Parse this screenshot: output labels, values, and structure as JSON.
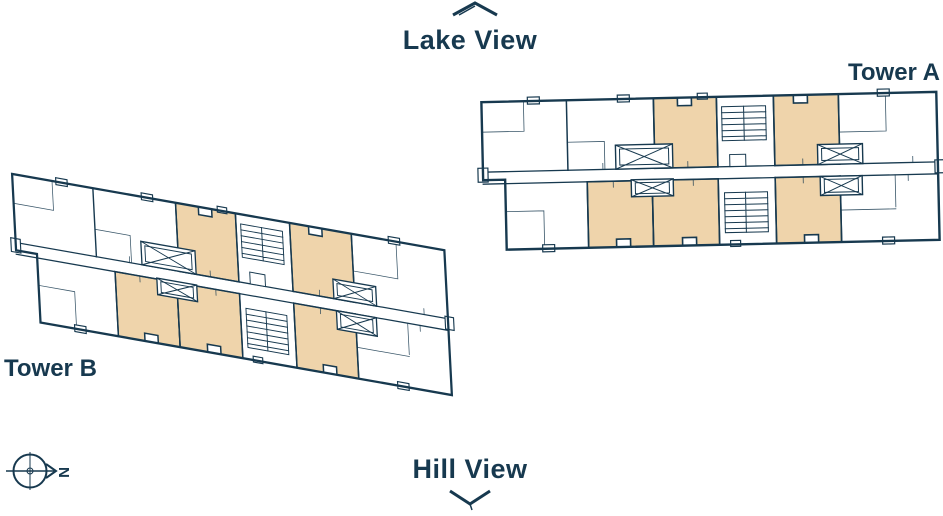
{
  "canvas": {
    "width": 943,
    "height": 516,
    "background": "#ffffff"
  },
  "colors": {
    "line_navy": "#17394f",
    "highlighted_unit_beige": "#efd4ab",
    "plan_background": "#ffffff"
  },
  "header": {
    "lake_view_label": "Lake View"
  },
  "footer": {
    "hill_view_label": "Hill View"
  },
  "towers": {
    "tower_a": {
      "label": "Tower A",
      "highlighted_units": 5,
      "outline_units": 5
    },
    "tower_b": {
      "label": "Tower B",
      "highlighted_units": 5,
      "outline_units": 5
    }
  },
  "compass": {
    "north_label": "N"
  },
  "icons": {
    "chevron_up": "direction marker toward Lake View",
    "chevron_down": "direction marker toward Hill View",
    "compass": "north arrow compass"
  }
}
